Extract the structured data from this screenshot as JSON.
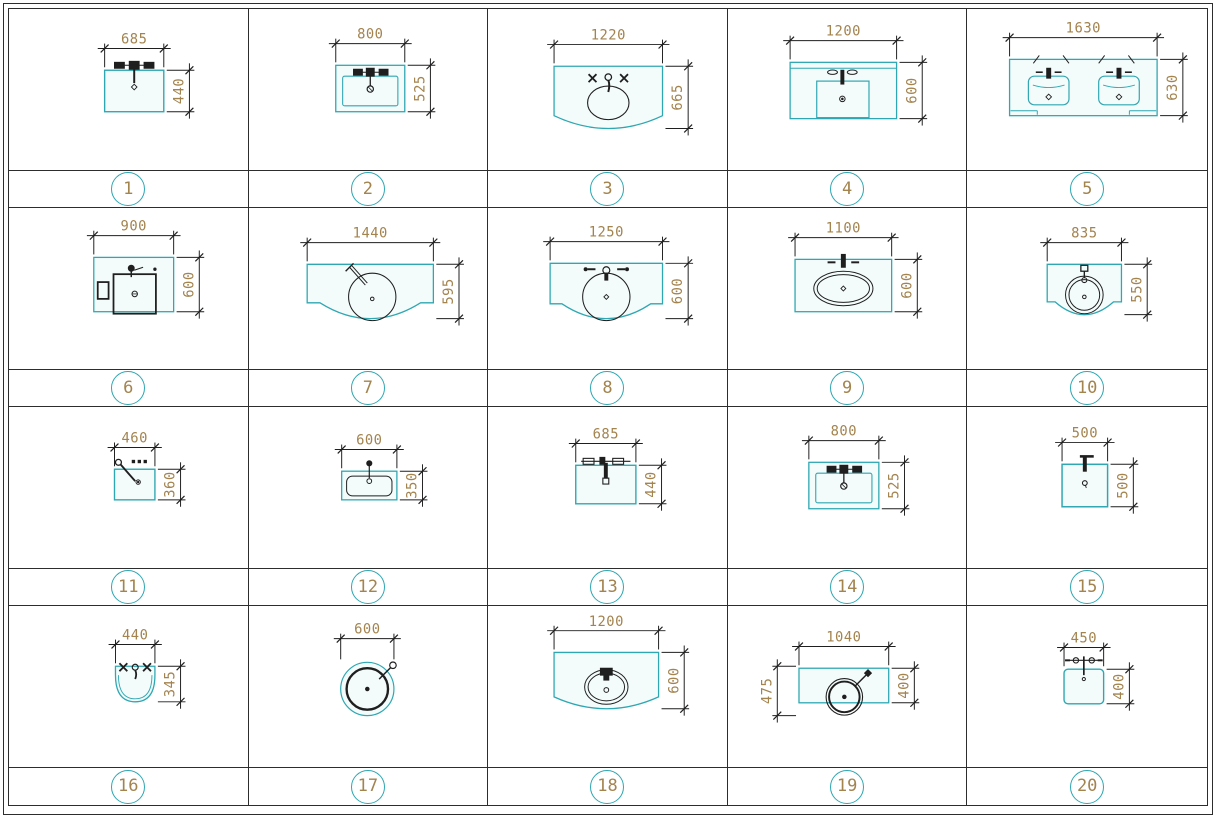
{
  "colors": {
    "fixture": "#2ea7b2",
    "dim_text": "#a3834e",
    "line": "#1f1f1f",
    "grid_line": "#2d2d2d"
  },
  "items": [
    {
      "num": "1",
      "width": "685",
      "height": "440",
      "shape": "rect_faucet"
    },
    {
      "num": "2",
      "width": "800",
      "height": "525",
      "shape": "rect_basin"
    },
    {
      "num": "3",
      "width": "1220",
      "height": "665",
      "shape": "curve_oval"
    },
    {
      "num": "4",
      "width": "1200",
      "height": "600",
      "shape": "counter_rect"
    },
    {
      "num": "5",
      "width": "1630",
      "height": "630",
      "shape": "double_vanity"
    },
    {
      "num": "6",
      "width": "900",
      "height": "600",
      "shape": "counter_square"
    },
    {
      "num": "7",
      "width": "1440",
      "height": "595",
      "shape": "curve_round_diag"
    },
    {
      "num": "8",
      "width": "1250",
      "height": "600",
      "shape": "curve_round"
    },
    {
      "num": "9",
      "width": "1100",
      "height": "600",
      "shape": "rect_oval"
    },
    {
      "num": "10",
      "width": "835",
      "height": "550",
      "shape": "curve_small"
    },
    {
      "num": "11",
      "width": "460",
      "height": "360",
      "shape": "rect_diag"
    },
    {
      "num": "12",
      "width": "600",
      "height": "350",
      "shape": "rect_round_inner"
    },
    {
      "num": "13",
      "width": "685",
      "height": "440",
      "shape": "rect_bar"
    },
    {
      "num": "14",
      "width": "800",
      "height": "525",
      "shape": "rect_basin"
    },
    {
      "num": "15",
      "width": "500",
      "height": "500",
      "shape": "square_faucet"
    },
    {
      "num": "16",
      "width": "440",
      "height": "345",
      "shape": "half_oval"
    },
    {
      "num": "17",
      "width": "600",
      "shape": "round_basin"
    },
    {
      "num": "18",
      "width": "1200",
      "height": "600",
      "shape": "curve_oval_small"
    },
    {
      "num": "19",
      "width": "1040",
      "height": "400",
      "height_left": "475",
      "shape": "counter_vessel"
    },
    {
      "num": "20",
      "width": "450",
      "height": "400",
      "shape": "rounded_square"
    }
  ]
}
